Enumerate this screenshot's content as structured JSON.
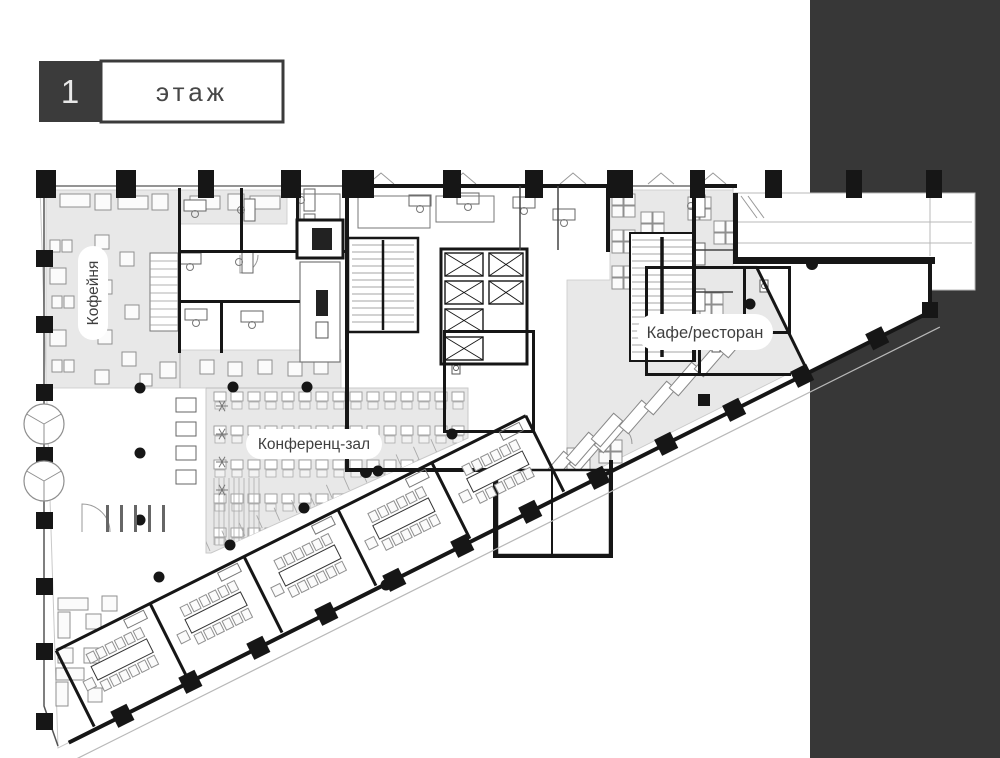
{
  "header": {
    "floor_number": "1",
    "floor_label": "этаж"
  },
  "labels": {
    "coffee": "Кофейня",
    "cafe": "Кафе/ресторан",
    "conference": "Конференц-зал"
  },
  "colors": {
    "background": "#ffffff",
    "side_panel": "#373737",
    "zone_fill": "#e8e8e8",
    "zone_border": "#c9c9c9",
    "wall": "#161616",
    "line_light": "#b8b8b8",
    "line_mid": "#555555",
    "furniture_stroke": "#8f8f8f",
    "furniture_fill": "#fbfbfb",
    "label_bg": "#ffffff",
    "label_text": "#3f3f3f",
    "badge_bg": "#3b3b3b",
    "badge_digit": "#e8e8e8",
    "badge_border": "#3b3b3b"
  }
}
